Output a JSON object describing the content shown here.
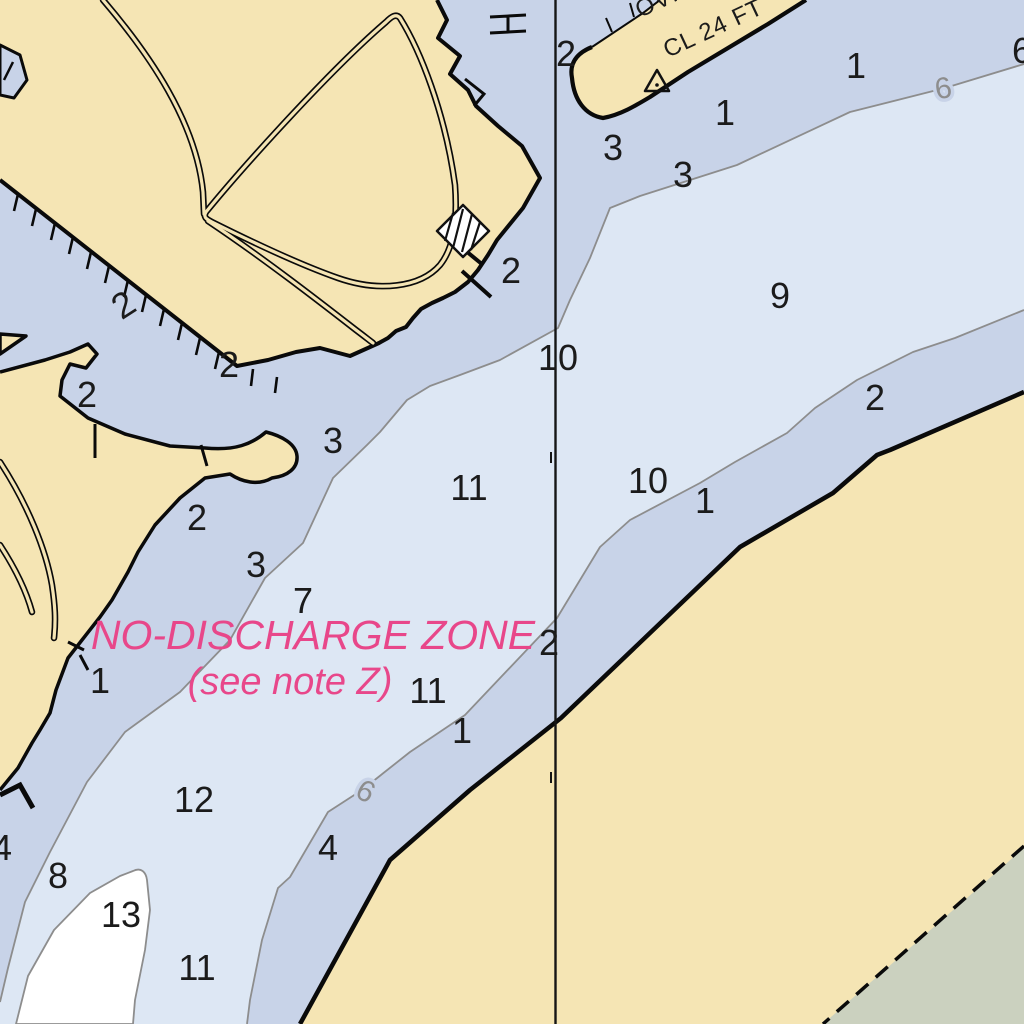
{
  "chart": {
    "kind": "nautical-chart-section",
    "labels": {
      "zone_line1": "NO-DISCHARGE ZONE",
      "zone_line2": "(see note Z)",
      "overhead_line1": "OVHD",
      "overhead_line2": "CL 24 FT"
    },
    "colors": {
      "land": "#f5e5b4",
      "shallow_water": "#c8d3e8",
      "mid_water": "#dde7f4",
      "deep_water": "#ffffff",
      "marsh": "#cbd1bf",
      "contour_gray": "#8d8d8d",
      "zone_text": "#e8478a",
      "ink": "#111111"
    },
    "soundings": [
      {
        "v": "2",
        "x": 566,
        "y": 66
      },
      {
        "v": "3",
        "x": 613,
        "y": 160
      },
      {
        "v": "3",
        "x": 683,
        "y": 187
      },
      {
        "v": "1",
        "x": 725,
        "y": 125
      },
      {
        "v": "1",
        "x": 856,
        "y": 78
      },
      {
        "v": "6",
        "x": 1022,
        "y": 63
      },
      {
        "v": "9",
        "x": 780,
        "y": 308
      },
      {
        "v": "2",
        "x": 875,
        "y": 410
      },
      {
        "v": "10",
        "x": 558,
        "y": 370
      },
      {
        "v": "10",
        "x": 648,
        "y": 493
      },
      {
        "v": "1",
        "x": 705,
        "y": 513
      },
      {
        "v": "2",
        "x": 511,
        "y": 283
      },
      {
        "v": "2",
        "x": 130,
        "y": 315,
        "rot": -33
      },
      {
        "v": "2",
        "x": 229,
        "y": 377
      },
      {
        "v": "3",
        "x": 333,
        "y": 453
      },
      {
        "v": "11",
        "x": 469,
        "y": 500
      },
      {
        "v": "2",
        "x": 87,
        "y": 407
      },
      {
        "v": "2",
        "x": 197,
        "y": 530
      },
      {
        "v": "3",
        "x": 256,
        "y": 577
      },
      {
        "v": "7",
        "x": 303,
        "y": 613
      },
      {
        "v": "1",
        "x": 100,
        "y": 693
      },
      {
        "v": "2",
        "x": 549,
        "y": 655
      },
      {
        "v": "11",
        "x": 428,
        "y": 703
      },
      {
        "v": "1",
        "x": 462,
        "y": 743
      },
      {
        "v": "12",
        "x": 194,
        "y": 812
      },
      {
        "v": "4",
        "x": 2,
        "y": 860
      },
      {
        "v": "8",
        "x": 58,
        "y": 888
      },
      {
        "v": "13",
        "x": 121,
        "y": 927
      },
      {
        "v": "11",
        "x": 197,
        "y": 980
      },
      {
        "v": "4",
        "x": 328,
        "y": 860
      }
    ],
    "contour_labels": [
      {
        "v": "6",
        "x": 945,
        "y": 98,
        "rot": -10
      },
      {
        "v": "6",
        "x": 361,
        "y": 800,
        "rot": 28
      }
    ],
    "symbols": [
      {
        "name": "triangle-beacon",
        "x": 657,
        "y": 84
      },
      {
        "name": "hatched-building",
        "x": 463,
        "y": 231
      }
    ]
  }
}
